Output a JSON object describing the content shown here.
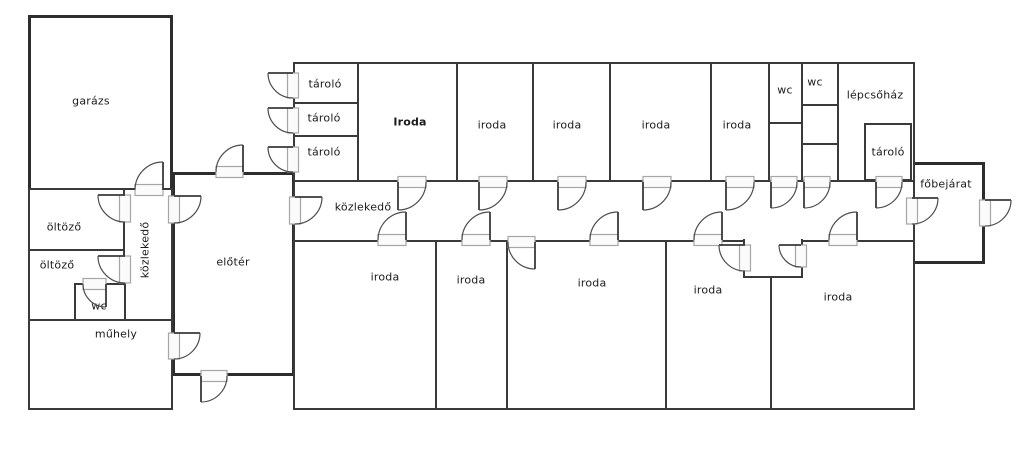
{
  "floor_plan": {
    "canvas": {
      "w": 1024,
      "h": 450,
      "bg": "#ffffff",
      "wall_color": "#3a3a3a",
      "label_color": "#1b1b1b",
      "frame_color": "#a6a6a6"
    },
    "rooms": [
      {
        "id": "garazs",
        "label": "garázs",
        "x": 28,
        "y": 15,
        "w": 145,
        "h": 176,
        "lx": 91,
        "ly": 101,
        "thick": true
      },
      {
        "id": "left-wing",
        "x": 28,
        "y": 188,
        "w": 145,
        "h": 222,
        "thick": true
      },
      {
        "id": "eloter",
        "label": "előtér",
        "x": 172,
        "y": 172,
        "w": 123,
        "h": 204,
        "lx": 233,
        "ly": 262,
        "thick": true
      },
      {
        "id": "main-wing",
        "x": 293,
        "y": 62,
        "w": 622,
        "h": 348,
        "thick": true
      },
      {
        "id": "fobejarat",
        "label": "főbejárat",
        "x": 912,
        "y": 162,
        "w": 73,
        "h": 102,
        "lx": 946,
        "ly": 184,
        "thick": true
      },
      {
        "id": "kozlekedo-h",
        "label": "közlekedő",
        "x": 293,
        "y": 180,
        "w": 622,
        "h": 62,
        "lx": 363,
        "ly": 207
      },
      {
        "id": "oltozo-1",
        "label": "öltöző",
        "x": 28,
        "y": 188,
        "w": 97,
        "h": 63,
        "lx": 64,
        "ly": 227
      },
      {
        "id": "oltozo-2",
        "label": "öltöző",
        "x": 28,
        "y": 249,
        "w": 97,
        "h": 72,
        "lx": 57,
        "ly": 265
      },
      {
        "id": "kozlekedo-v",
        "label": "közlekedő",
        "x": 123,
        "y": 188,
        "w": 50,
        "h": 133,
        "lx": 145,
        "ly": 250,
        "vertical": true
      },
      {
        "id": "wc-left",
        "label": "wc",
        "x": 74,
        "y": 283,
        "w": 52,
        "h": 38,
        "lx": 99,
        "ly": 306
      },
      {
        "id": "muhely",
        "label": "műhely",
        "x": 28,
        "y": 319,
        "w": 145,
        "h": 91,
        "lx": 116,
        "ly": 334
      },
      {
        "id": "tarolo-1",
        "label": "tároló",
        "x": 293,
        "y": 62,
        "w": 66,
        "h": 42,
        "lx": 325,
        "ly": 84
      },
      {
        "id": "tarolo-2",
        "label": "tároló",
        "x": 293,
        "y": 102,
        "w": 66,
        "h": 35,
        "lx": 324,
        "ly": 118
      },
      {
        "id": "tarolo-3",
        "label": "tároló",
        "x": 293,
        "y": 135,
        "w": 66,
        "h": 47,
        "lx": 324,
        "ly": 152
      },
      {
        "id": "iroda-t1",
        "label": "Iroda",
        "x": 357,
        "y": 62,
        "w": 101,
        "h": 120,
        "lx": 410,
        "ly": 122,
        "bold": true
      },
      {
        "id": "iroda-t2",
        "label": "iroda",
        "x": 456,
        "y": 62,
        "w": 78,
        "h": 120,
        "lx": 492,
        "ly": 125
      },
      {
        "id": "iroda-t3",
        "label": "iroda",
        "x": 532,
        "y": 62,
        "w": 79,
        "h": 120,
        "lx": 567,
        "ly": 125
      },
      {
        "id": "iroda-t4",
        "label": "iroda",
        "x": 609,
        "y": 62,
        "w": 103,
        "h": 120,
        "lx": 656,
        "ly": 125
      },
      {
        "id": "iroda-t5",
        "label": "iroda",
        "x": 710,
        "y": 62,
        "w": 60,
        "h": 120,
        "lx": 737,
        "ly": 125
      },
      {
        "id": "wc-t1",
        "label": "wc",
        "x": 768,
        "y": 62,
        "w": 35,
        "h": 62,
        "lx": 785,
        "ly": 90
      },
      {
        "id": "wc-t1-store",
        "x": 768,
        "y": 122,
        "w": 35,
        "h": 60
      },
      {
        "id": "wc-t2",
        "label": "wc",
        "x": 801,
        "y": 62,
        "w": 38,
        "h": 44,
        "lx": 815,
        "ly": 82
      },
      {
        "id": "wc-t2-mid",
        "x": 801,
        "y": 104,
        "w": 38,
        "h": 41
      },
      {
        "id": "wc-t2-bot",
        "x": 801,
        "y": 143,
        "w": 38,
        "h": 39
      },
      {
        "id": "lepcsohaz",
        "label": "lépcsőház",
        "x": 837,
        "y": 62,
        "w": 78,
        "h": 120,
        "lx": 875,
        "ly": 95
      },
      {
        "id": "tarolo-4",
        "label": "tároló",
        "x": 864,
        "y": 123,
        "w": 48,
        "h": 58,
        "lx": 888,
        "ly": 152
      },
      {
        "id": "iroda-b1",
        "label": "iroda",
        "x": 293,
        "y": 240,
        "w": 144,
        "h": 170,
        "lx": 385,
        "ly": 277
      },
      {
        "id": "iroda-b2",
        "label": "iroda",
        "x": 435,
        "y": 240,
        "w": 73,
        "h": 170,
        "lx": 471,
        "ly": 280
      },
      {
        "id": "iroda-b3",
        "label": "iroda",
        "x": 506,
        "y": 240,
        "w": 161,
        "h": 170,
        "lx": 592,
        "ly": 283
      },
      {
        "id": "iroda-b4",
        "label": "iroda",
        "x": 665,
        "y": 240,
        "w": 107,
        "h": 170,
        "lx": 708,
        "ly": 290
      },
      {
        "id": "iroda-b5",
        "label": "iroda",
        "x": 770,
        "y": 240,
        "w": 145,
        "h": 170,
        "lx": 838,
        "ly": 297
      },
      {
        "id": "entry-nook",
        "x": 743,
        "y": 239,
        "w": 60,
        "h": 39,
        "open_top": true
      }
    ],
    "doors": [
      {
        "id": "garazs",
        "hx": 163,
        "hy": 190,
        "r": 28,
        "a1": 270,
        "a2": 180,
        "sweep": 0
      },
      {
        "id": "eloter-ext-top",
        "hx": 243,
        "hy": 172,
        "r": 27,
        "a1": 270,
        "a2": 180,
        "sweep": 0
      },
      {
        "id": "eloter-left-wing",
        "hx": 174,
        "hy": 196,
        "r": 27,
        "a1": 0,
        "a2": 90,
        "sweep": 1
      },
      {
        "id": "oltozo-1",
        "hx": 125,
        "hy": 195,
        "r": 27,
        "a1": 180,
        "a2": 90,
        "sweep": 0
      },
      {
        "id": "oltozo-2",
        "hx": 125,
        "hy": 256,
        "r": 27,
        "a1": 180,
        "a2": 90,
        "sweep": 0
      },
      {
        "id": "wc-left",
        "hx": 106,
        "hy": 284,
        "r": 23,
        "a1": 90,
        "a2": 180,
        "sweep": 1
      },
      {
        "id": "muhely-eloter",
        "hx": 174,
        "hy": 333,
        "r": 26,
        "a1": 0,
        "a2": 90,
        "sweep": 1
      },
      {
        "id": "eloter-ext-bottom",
        "hx": 201,
        "hy": 376,
        "r": 26,
        "a1": 90,
        "a2": 0,
        "sweep": 0
      },
      {
        "id": "tarolo-1-ext",
        "hx": 293,
        "hy": 73,
        "r": 25,
        "a1": 180,
        "a2": 90,
        "sweep": 0
      },
      {
        "id": "tarolo-2-ext",
        "hx": 293,
        "hy": 108,
        "r": 25,
        "a1": 180,
        "a2": 90,
        "sweep": 0
      },
      {
        "id": "tarolo-3-ext",
        "hx": 293,
        "hy": 147,
        "r": 25,
        "a1": 180,
        "a2": 90,
        "sweep": 0
      },
      {
        "id": "corridor-eloter",
        "hx": 295,
        "hy": 197,
        "r": 27,
        "a1": 0,
        "a2": 90,
        "sweep": 1
      },
      {
        "id": "corridor-t1",
        "hx": 398,
        "hy": 182,
        "r": 28,
        "a1": 90,
        "a2": 0,
        "sweep": 0
      },
      {
        "id": "corridor-t2",
        "hx": 479,
        "hy": 182,
        "r": 28,
        "a1": 90,
        "a2": 0,
        "sweep": 0
      },
      {
        "id": "corridor-t3",
        "hx": 558,
        "hy": 182,
        "r": 28,
        "a1": 90,
        "a2": 0,
        "sweep": 0
      },
      {
        "id": "corridor-t4",
        "hx": 643,
        "hy": 182,
        "r": 28,
        "a1": 90,
        "a2": 0,
        "sweep": 0
      },
      {
        "id": "corridor-t5",
        "hx": 726,
        "hy": 182,
        "r": 28,
        "a1": 90,
        "a2": 0,
        "sweep": 0
      },
      {
        "id": "corridor-wc1",
        "hx": 771,
        "hy": 182,
        "r": 26,
        "a1": 90,
        "a2": 0,
        "sweep": 0
      },
      {
        "id": "corridor-wc2",
        "hx": 804,
        "hy": 182,
        "r": 26,
        "a1": 90,
        "a2": 0,
        "sweep": 0
      },
      {
        "id": "corridor-stairs",
        "hx": 876,
        "hy": 182,
        "r": 26,
        "a1": 90,
        "a2": 0,
        "sweep": 0
      },
      {
        "id": "corridor-b1",
        "hx": 406,
        "hy": 240,
        "r": 28,
        "a1": 270,
        "a2": 180,
        "sweep": 0
      },
      {
        "id": "corridor-b2",
        "hx": 490,
        "hy": 240,
        "r": 28,
        "a1": 270,
        "a2": 180,
        "sweep": 0
      },
      {
        "id": "corridor-b3",
        "hx": 618,
        "hy": 240,
        "r": 28,
        "a1": 270,
        "a2": 180,
        "sweep": 0
      },
      {
        "id": "corridor-b4",
        "hx": 722,
        "hy": 240,
        "r": 28,
        "a1": 270,
        "a2": 180,
        "sweep": 0
      },
      {
        "id": "corridor-b5",
        "hx": 857,
        "hy": 240,
        "r": 28,
        "a1": 270,
        "a2": 180,
        "sweep": 0
      },
      {
        "id": "iroda-b3-side",
        "hx": 535,
        "hy": 242,
        "r": 27,
        "a1": 90,
        "a2": 180,
        "sweep": 1
      },
      {
        "id": "corridor-fobejarat",
        "hx": 912,
        "hy": 198,
        "r": 26,
        "a1": 0,
        "a2": 90,
        "sweep": 1
      },
      {
        "id": "fobejarat-ext",
        "hx": 985,
        "hy": 200,
        "r": 26,
        "a1": 0,
        "a2": 90,
        "sweep": 1
      },
      {
        "id": "nook-b4",
        "hx": 745,
        "hy": 245,
        "r": 26,
        "a1": 180,
        "a2": 90,
        "sweep": 0
      },
      {
        "id": "nook-inner",
        "hx": 801,
        "hy": 245,
        "r": 22,
        "a1": 180,
        "a2": 90,
        "sweep": 0
      }
    ]
  }
}
